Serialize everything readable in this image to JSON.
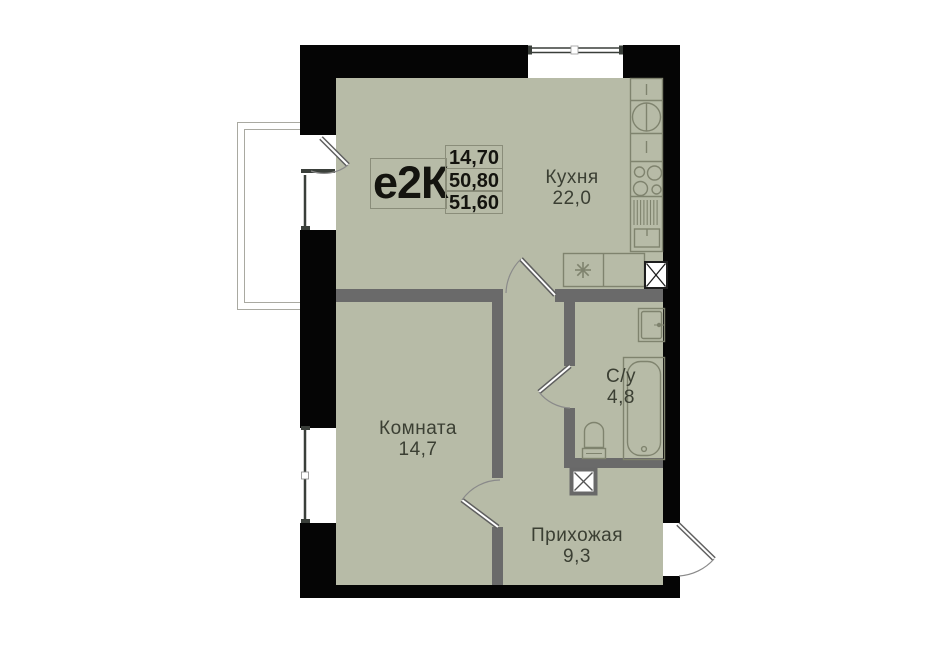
{
  "plan": {
    "type_label": "е2К",
    "area_values": [
      "14,70",
      "50,80",
      "51,60"
    ],
    "rooms": [
      {
        "id": "kitchen",
        "name": "Кухня",
        "area": "22,0"
      },
      {
        "id": "room",
        "name": "Комната",
        "area": "14,7"
      },
      {
        "id": "bathroom",
        "name": "С/у",
        "area": "4,8"
      },
      {
        "id": "hallway",
        "name": "Прихожая",
        "area": "9,3"
      }
    ],
    "colors": {
      "floor": "#b7bba7",
      "exterior_wall": "#050505",
      "interior_wall": "#6a6a6a",
      "fixture_line": "#7f836e",
      "text": "#3b3f33",
      "label_border": "#8a8d7a"
    }
  }
}
